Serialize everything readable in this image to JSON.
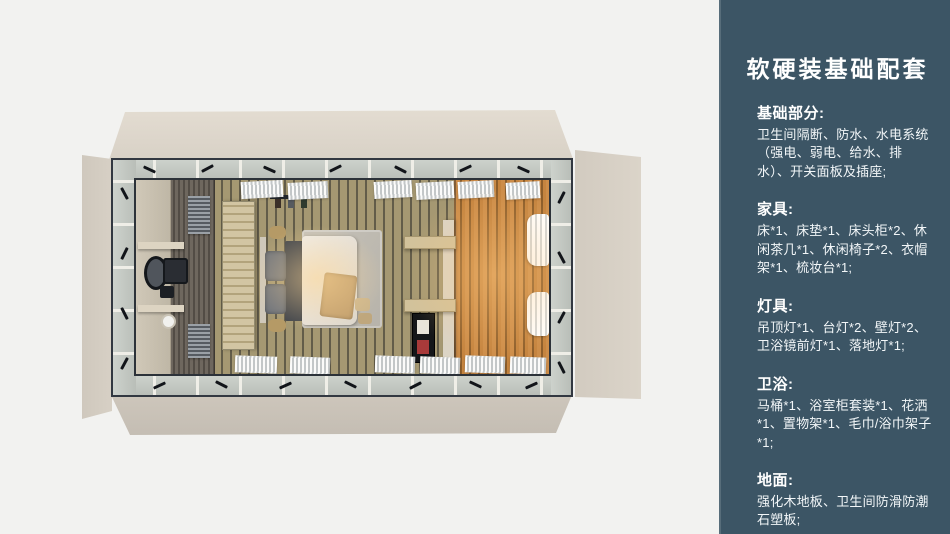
{
  "background_color": "#f2f2f0",
  "panel": {
    "title": "软硬装基础配套",
    "accent_color": "#3c5565",
    "text_color": "#ffffff",
    "sections": [
      {
        "heading": "基础部分:",
        "body": "卫生间隔断、防水、水电系统（强电、弱电、给水、排水）、开关面板及插座;"
      },
      {
        "heading": "家具:",
        "body": "床*1、床垫*1、床头柜*2、休闲茶几*1、休闲椅子*2、衣帽架*1、梳妆台*1;"
      },
      {
        "heading": "灯具:",
        "body": "吊顶灯*1、台灯*2、壁灯*2、卫浴镜前灯*1、落地灯*1;"
      },
      {
        "heading": "卫浴:",
        "body": "马桶*1、浴室柜套装*1、花洒*1、置物架*1、毛巾/浴巾架子*1;"
      },
      {
        "heading": "地面:",
        "body": "强化木地板、卫生间防滑防潮石塑板;"
      }
    ]
  }
}
